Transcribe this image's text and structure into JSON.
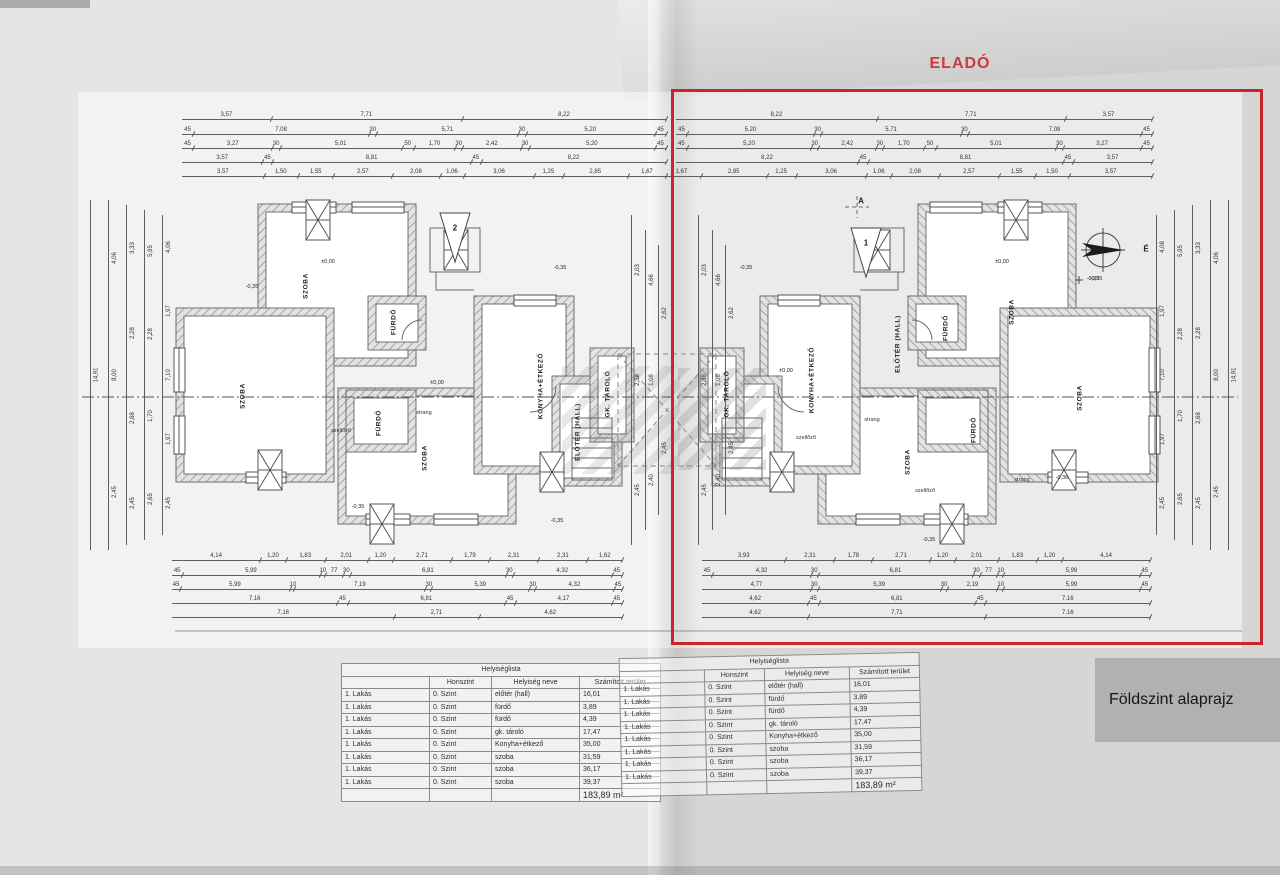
{
  "page": {
    "for_sale_label": "ELADÓ",
    "caption": "Földszint alaprajz"
  },
  "colors": {
    "highlight_red": "#c8252c",
    "caption_bg": "#b2b1af",
    "paper": "#d7d6d4"
  },
  "compass": {
    "north_label": "É",
    "level_label": "-0,35"
  },
  "section_markers": [
    {
      "label": "2",
      "x": 455,
      "y": 228
    },
    {
      "label": "A",
      "x": 861,
      "y": 201
    },
    {
      "label": "1",
      "x": 866,
      "y": 243
    }
  ],
  "room_labels": [
    {
      "t": "SZOBA",
      "x": 306,
      "y": 286
    },
    {
      "t": "SZOBA",
      "x": 243,
      "y": 396
    },
    {
      "t": "SZOBA",
      "x": 425,
      "y": 458
    },
    {
      "t": "KONYHA+ÉTKEZŐ",
      "x": 541,
      "y": 386
    },
    {
      "t": "ELŐTÉR (HALL)",
      "x": 578,
      "y": 432
    },
    {
      "t": "FÜRDŐ",
      "x": 394,
      "y": 322
    },
    {
      "t": "FÜRDŐ",
      "x": 379,
      "y": 423
    },
    {
      "t": "GK. TÁROLÓ",
      "x": 608,
      "y": 394
    },
    {
      "t": "SZOBA",
      "x": 1012,
      "y": 312
    },
    {
      "t": "SZOBA",
      "x": 1080,
      "y": 398
    },
    {
      "t": "SZOBA",
      "x": 908,
      "y": 462
    },
    {
      "t": "KONYHA+ÉTKEZŐ",
      "x": 812,
      "y": 380
    },
    {
      "t": "ELŐTÉR (HALL)",
      "x": 898,
      "y": 344
    },
    {
      "t": "FÜRDŐ",
      "x": 946,
      "y": 328
    },
    {
      "t": "FÜRDŐ",
      "x": 974,
      "y": 430
    },
    {
      "t": "GK. TÁROLÓ",
      "x": 727,
      "y": 394
    }
  ],
  "level_labels": [
    {
      "t": "±0,00",
      "x": 328,
      "y": 262
    },
    {
      "t": "±0,00",
      "x": 437,
      "y": 383
    },
    {
      "t": "-0,35",
      "x": 252,
      "y": 287
    },
    {
      "t": "-0,35",
      "x": 560,
      "y": 268
    },
    {
      "t": "-0,35",
      "x": 358,
      "y": 507
    },
    {
      "t": "-0,35",
      "x": 557,
      "y": 521
    },
    {
      "t": "±0,00",
      "x": 786,
      "y": 371
    },
    {
      "t": "±0,00",
      "x": 1002,
      "y": 262
    },
    {
      "t": "-0,35",
      "x": 746,
      "y": 268
    },
    {
      "t": "-0,35",
      "x": 1093,
      "y": 279
    },
    {
      "t": "-0,35",
      "x": 929,
      "y": 540
    },
    {
      "t": "-0,36",
      "x": 1062,
      "y": 478
    }
  ],
  "annotations": [
    {
      "t": "szellőző",
      "x": 341,
      "y": 431
    },
    {
      "t": "strang",
      "x": 424,
      "y": 413
    },
    {
      "t": "szellőző",
      "x": 806,
      "y": 438
    },
    {
      "t": "strang",
      "x": 872,
      "y": 420
    },
    {
      "t": "szellőző",
      "x": 925,
      "y": 491
    },
    {
      "t": "strang",
      "x": 1022,
      "y": 480
    }
  ],
  "dim_rows": [
    {
      "y": 118,
      "x1": 182,
      "x2": 666,
      "labels": [
        "3,57",
        "7,71",
        "8,22"
      ]
    },
    {
      "y": 133,
      "x1": 182,
      "x2": 666,
      "labels": [
        "45",
        "7,08",
        "30",
        "5,71",
        "30",
        "5,20",
        "45"
      ]
    },
    {
      "y": 147,
      "x1": 182,
      "x2": 666,
      "labels": [
        "45",
        "3,27",
        "30",
        "5,01",
        "50",
        "1,70",
        "30",
        "2,42",
        "30",
        "5,20",
        "45"
      ]
    },
    {
      "y": 161,
      "x1": 182,
      "x2": 666,
      "labels": [
        "3,57",
        "45",
        "8,81",
        "45",
        "8,22"
      ]
    },
    {
      "y": 175,
      "x1": 182,
      "x2": 666,
      "labels": [
        "3,57",
        "1,50",
        "1,55",
        "2,57",
        "2,08",
        "1,06",
        "3,06",
        "1,25",
        "2,85",
        "1,67"
      ]
    },
    {
      "y": 118,
      "x1": 676,
      "x2": 1152,
      "labels": [
        "8,22",
        "7,71",
        "3,57"
      ]
    },
    {
      "y": 133,
      "x1": 676,
      "x2": 1152,
      "labels": [
        "45",
        "5,20",
        "30",
        "5,71",
        "30",
        "7,08",
        "45"
      ]
    },
    {
      "y": 147,
      "x1": 676,
      "x2": 1152,
      "labels": [
        "45",
        "5,20",
        "30",
        "2,42",
        "30",
        "1,70",
        "50",
        "5,01",
        "30",
        "3,27",
        "45"
      ]
    },
    {
      "y": 161,
      "x1": 676,
      "x2": 1152,
      "labels": [
        "8,22",
        "45",
        "8,81",
        "45",
        "3,57"
      ]
    },
    {
      "y": 175,
      "x1": 662,
      "x2": 1152,
      "labels": [
        "1,67",
        "2,85",
        "1,25",
        "3,06",
        "1,06",
        "2,08",
        "2,57",
        "1,55",
        "1,50",
        "3,57"
      ]
    },
    {
      "y": 559,
      "x1": 172,
      "x2": 622,
      "labels": [
        "4,14",
        "1,20",
        "1,83",
        "2,01",
        "1,20",
        "2,71",
        "1,79",
        "2,31",
        "2,31",
        "1,62"
      ]
    },
    {
      "y": 574,
      "x1": 172,
      "x2": 622,
      "labels": [
        "45",
        "5,99",
        "10",
        "77",
        "30",
        "6,81",
        "30",
        "4,32",
        "45"
      ]
    },
    {
      "y": 588,
      "x1": 172,
      "x2": 622,
      "labels": [
        "45",
        "5,99",
        "10",
        "7,19",
        "30",
        "5,39",
        "30",
        "4,32",
        "45"
      ]
    },
    {
      "y": 602,
      "x1": 172,
      "x2": 622,
      "labels": [
        "7,16",
        "45",
        "6,81",
        "45",
        "4,17",
        "45"
      ]
    },
    {
      "y": 616,
      "x1": 172,
      "x2": 622,
      "labels": [
        "7,16",
        "2,71",
        "4,62"
      ]
    },
    {
      "y": 559,
      "x1": 702,
      "x2": 1150,
      "labels": [
        "3,93",
        "2,31",
        "1,78",
        "2,71",
        "1,20",
        "2,01",
        "1,83",
        "1,20",
        "4,14"
      ]
    },
    {
      "y": 574,
      "x1": 702,
      "x2": 1150,
      "labels": [
        "45",
        "4,32",
        "30",
        "6,81",
        "30",
        "77",
        "10",
        "5,99",
        "45"
      ]
    },
    {
      "y": 588,
      "x1": 702,
      "x2": 1150,
      "labels": [
        "4,77",
        "30",
        "5,39",
        "30",
        "2,19",
        "10",
        "5,99",
        "45"
      ]
    },
    {
      "y": 602,
      "x1": 702,
      "x2": 1150,
      "labels": [
        "4,62",
        "45",
        "6,81",
        "45",
        "7,16"
      ]
    },
    {
      "y": 616,
      "x1": 702,
      "x2": 1150,
      "labels": [
        "4,62",
        "7,71",
        "7,16"
      ]
    }
  ],
  "dim_cols": [
    {
      "x": 95,
      "y1": 200,
      "y2": 550,
      "labels": [
        "14,91"
      ]
    },
    {
      "x": 113,
      "y1": 200,
      "y2": 550,
      "labels": [
        "4,06",
        "8,00",
        "2,45"
      ]
    },
    {
      "x": 131,
      "y1": 205,
      "y2": 545,
      "labels": [
        "3,33",
        "2,28",
        "2,68",
        "2,45"
      ]
    },
    {
      "x": 149,
      "y1": 210,
      "y2": 540,
      "labels": [
        "5,95",
        "2,28",
        "1,70",
        "2,65"
      ]
    },
    {
      "x": 167,
      "y1": 215,
      "y2": 535,
      "labels": [
        "4,06",
        "1,97",
        "7,10",
        "1,97",
        "2,45"
      ]
    },
    {
      "x": 1233,
      "y1": 200,
      "y2": 550,
      "labels": [
        "14,91"
      ]
    },
    {
      "x": 1215,
      "y1": 200,
      "y2": 550,
      "labels": [
        "4,06",
        "8,00",
        "2,45"
      ]
    },
    {
      "x": 1197,
      "y1": 205,
      "y2": 545,
      "labels": [
        "3,33",
        "2,28",
        "2,68",
        "2,45"
      ]
    },
    {
      "x": 1179,
      "y1": 210,
      "y2": 540,
      "labels": [
        "5,95",
        "2,28",
        "1,70",
        "2,65"
      ]
    },
    {
      "x": 1161,
      "y1": 215,
      "y2": 535,
      "labels": [
        "4,08",
        "1,97",
        "7,10",
        "1,97",
        "2,45"
      ]
    },
    {
      "x": 636,
      "y1": 215,
      "y2": 545,
      "labels": [
        "2,03",
        "2,38",
        "2,45"
      ]
    },
    {
      "x": 650,
      "y1": 230,
      "y2": 530,
      "labels": [
        "4,66",
        "1,08",
        "2,40"
      ]
    },
    {
      "x": 663,
      "y1": 245,
      "y2": 515,
      "labels": [
        "2,62",
        "2,45"
      ]
    },
    {
      "x": 703,
      "y1": 215,
      "y2": 545,
      "labels": [
        "2,03",
        "2,38",
        "2,45"
      ]
    },
    {
      "x": 717,
      "y1": 230,
      "y2": 530,
      "labels": [
        "4,66",
        "1,08",
        "2,40"
      ]
    },
    {
      "x": 730,
      "y1": 245,
      "y2": 515,
      "labels": [
        "2,62",
        "2,45"
      ]
    }
  ],
  "room_table": {
    "title": "Helyiséglista",
    "columns": [
      "",
      "Honszint",
      "Helyiség neve",
      "Számított terület"
    ],
    "unit_label": "1. Lakás",
    "level_label": "0. Szint",
    "rows": [
      [
        "előtér (hall)",
        "16,01"
      ],
      [
        "fürdő",
        "3,89"
      ],
      [
        "fürdő",
        "4,39"
      ],
      [
        "gk. tároló",
        "17,47"
      ],
      [
        "Konyha+étkező",
        "35,00"
      ],
      [
        "szoba",
        "31,59"
      ],
      [
        "szoba",
        "36,17"
      ],
      [
        "szoba",
        "39,37"
      ]
    ],
    "total": "183,89 m²"
  }
}
